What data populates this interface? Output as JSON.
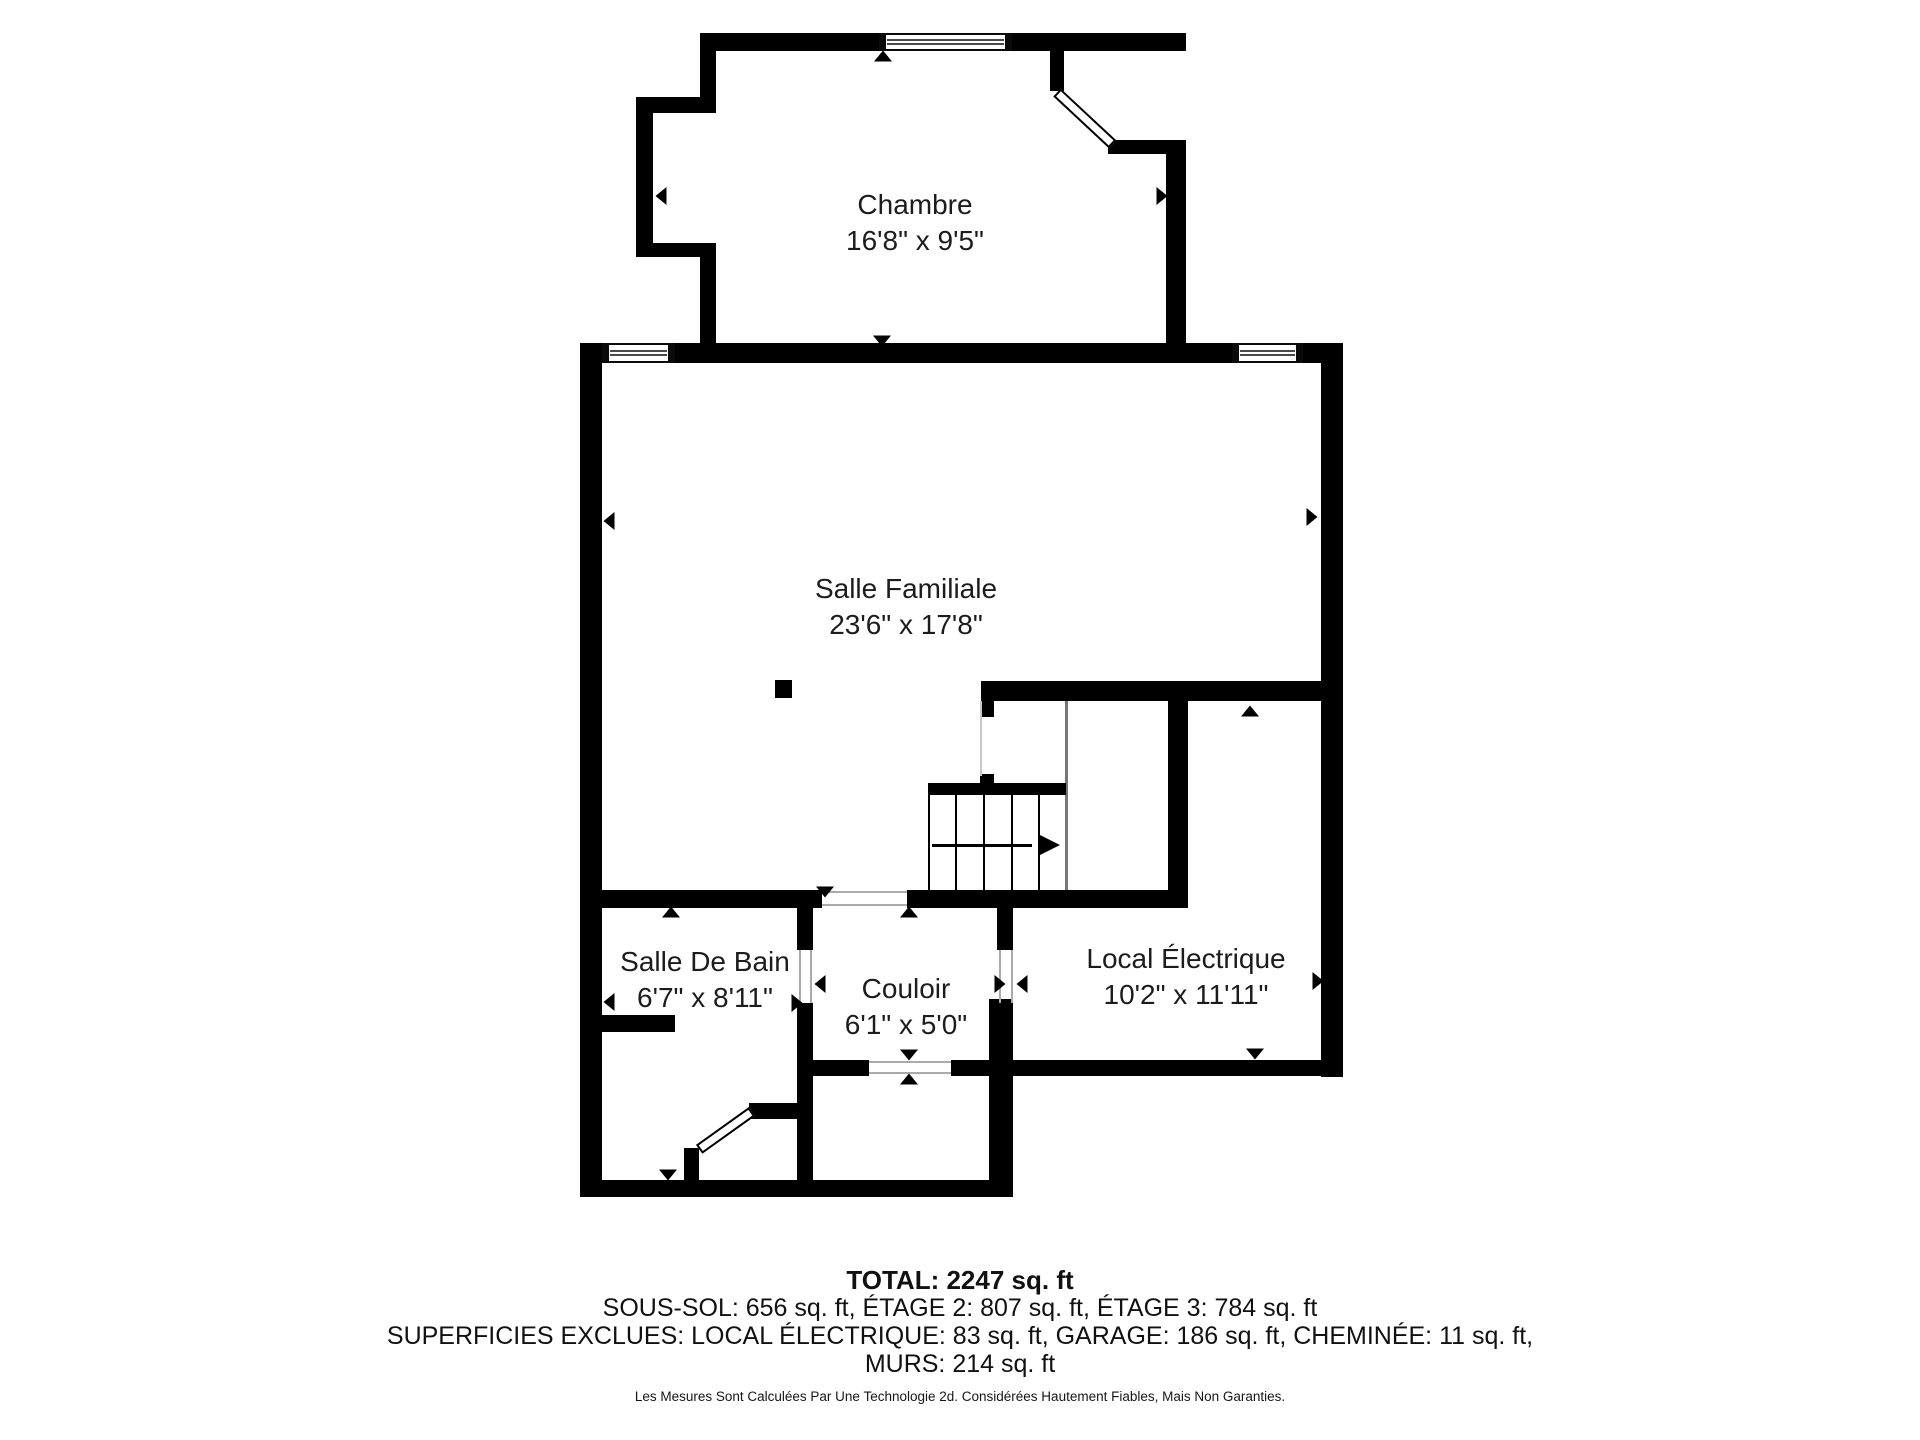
{
  "rooms": [
    {
      "name": "Chambre",
      "dimensions": "16'8\" x 9'5\""
    },
    {
      "name": "Salle Familiale",
      "dimensions": "23'6\" x 17'8\""
    },
    {
      "name": "Salle De Bain",
      "dimensions": "6'7\" x 8'11\""
    },
    {
      "name": "Couloir",
      "dimensions": "6'1\" x 5'0\""
    },
    {
      "name": "Local Électrique",
      "dimensions": "10'2\" x 11'11\""
    }
  ],
  "summary": {
    "total": "TOTAL: 2247 sq. ft",
    "floors": "SOUS-SOL: 656 sq. ft, ÉTAGE 2: 807 sq. ft, ÉTAGE 3: 784 sq. ft",
    "exclusions": "SUPERFICIES EXCLUES: LOCAL ÉLECTRIQUE: 83 sq. ft, GARAGE: 186 sq. ft, CHEMINÉE: 11 sq. ft,",
    "walls_area": "MURS: 214 sq. ft",
    "disclaimer": "Les Mesures Sont Calculées Par Une Technologie 2d. Considérées Hautement Fiables, Mais Non Garanties."
  },
  "colors": {
    "wall": "#000000",
    "rail_dark": "#777777",
    "rail_light": "#c8c8c8",
    "frame_line": "#aaaaaa",
    "background": "#ffffff",
    "text": "#1c1c1c"
  },
  "floorplan": {
    "walls": [
      [
        700,
        33,
        486,
        18
      ],
      [
        700,
        33,
        16,
        80
      ],
      [
        636,
        97,
        80,
        16
      ],
      [
        636,
        97,
        17,
        160
      ],
      [
        636,
        243,
        80,
        14
      ],
      [
        700,
        243,
        16,
        120
      ],
      [
        1166,
        140,
        20,
        223
      ],
      [
        1108,
        140,
        58,
        14
      ],
      [
        1050,
        51,
        14,
        40
      ],
      [
        580,
        343,
        763,
        20
      ],
      [
        580,
        343,
        22,
        854
      ],
      [
        1321,
        343,
        22,
        734
      ],
      [
        981,
        681,
        362,
        20
      ],
      [
        981,
        681,
        13,
        36
      ],
      [
        1168,
        681,
        20,
        227
      ],
      [
        907,
        890,
        281,
        18
      ],
      [
        580,
        890,
        242,
        18
      ],
      [
        797,
        908,
        16,
        42
      ],
      [
        797,
        1003,
        16,
        194
      ],
      [
        749,
        1103,
        64,
        16
      ],
      [
        684,
        1148,
        15,
        49
      ],
      [
        602,
        1015,
        73,
        17
      ],
      [
        797,
        1060,
        72,
        16
      ],
      [
        951,
        1060,
        62,
        16
      ],
      [
        997,
        908,
        16,
        42
      ],
      [
        989,
        999,
        24,
        198
      ],
      [
        1004,
        1060,
        339,
        16
      ],
      [
        580,
        1180,
        433,
        17
      ],
      [
        980,
        774,
        14,
        18
      ]
    ],
    "windows": [
      [
        879,
        33,
        133,
        18
      ],
      [
        602,
        343,
        73,
        20
      ],
      [
        1232,
        343,
        71,
        20
      ]
    ],
    "doors": [
      {
        "x": 1057,
        "y": 92,
        "len": 76,
        "angle": 43
      },
      {
        "x": 752,
        "y": 1111,
        "len": 65,
        "angle": 144.4
      }
    ],
    "rails": [
      {
        "x": 980,
        "y": 701,
        "w": 2,
        "h": 75,
        "shade": "light"
      },
      {
        "x": 1065,
        "y": 701,
        "w": 2.5,
        "h": 189,
        "shade": "dark"
      }
    ],
    "gap_lines": [
      [
        822,
        891,
        85,
        1.5
      ],
      [
        822,
        904,
        85,
        1.5
      ],
      [
        869,
        1061,
        82,
        1.5
      ],
      [
        869,
        1072,
        82,
        1.5
      ],
      [
        999,
        950,
        1.5,
        53
      ],
      [
        1011,
        950,
        1.5,
        53
      ],
      [
        799,
        950,
        1.5,
        53
      ],
      [
        810,
        950,
        1.5,
        53
      ]
    ],
    "stairs": {
      "bar": [
        928,
        783,
        138,
        12
      ],
      "tread_x": [
        928,
        955,
        983,
        1011,
        1038
      ],
      "tread_top": 795,
      "tread_bottom": 890,
      "tread_w": 2,
      "arrow_line": [
        932,
        844,
        100,
        2.5
      ],
      "arrow_head": {
        "x": 1040,
        "y": 845
      }
    },
    "post": [
      775,
      680,
      17,
      18
    ],
    "markers": [
      [
        883,
        56,
        "up"
      ],
      [
        661,
        196,
        "left"
      ],
      [
        1162,
        196,
        "right"
      ],
      [
        882,
        341,
        "down"
      ],
      [
        822,
        354,
        "up"
      ],
      [
        609,
        521,
        "left"
      ],
      [
        1312,
        517,
        "right"
      ],
      [
        1250,
        711,
        "up"
      ],
      [
        1318,
        981,
        "right"
      ],
      [
        1255,
        1054,
        "down"
      ],
      [
        825,
        892,
        "down"
      ],
      [
        909,
        912,
        "up"
      ],
      [
        671,
        912,
        "up"
      ],
      [
        609,
        1002,
        "left"
      ],
      [
        797,
        1003,
        "right"
      ],
      [
        820,
        984,
        "left"
      ],
      [
        1000,
        984,
        "right"
      ],
      [
        1022,
        984,
        "left"
      ],
      [
        909,
        1055,
        "down"
      ],
      [
        909,
        1079,
        "up"
      ],
      [
        668,
        1175,
        "down"
      ]
    ]
  }
}
